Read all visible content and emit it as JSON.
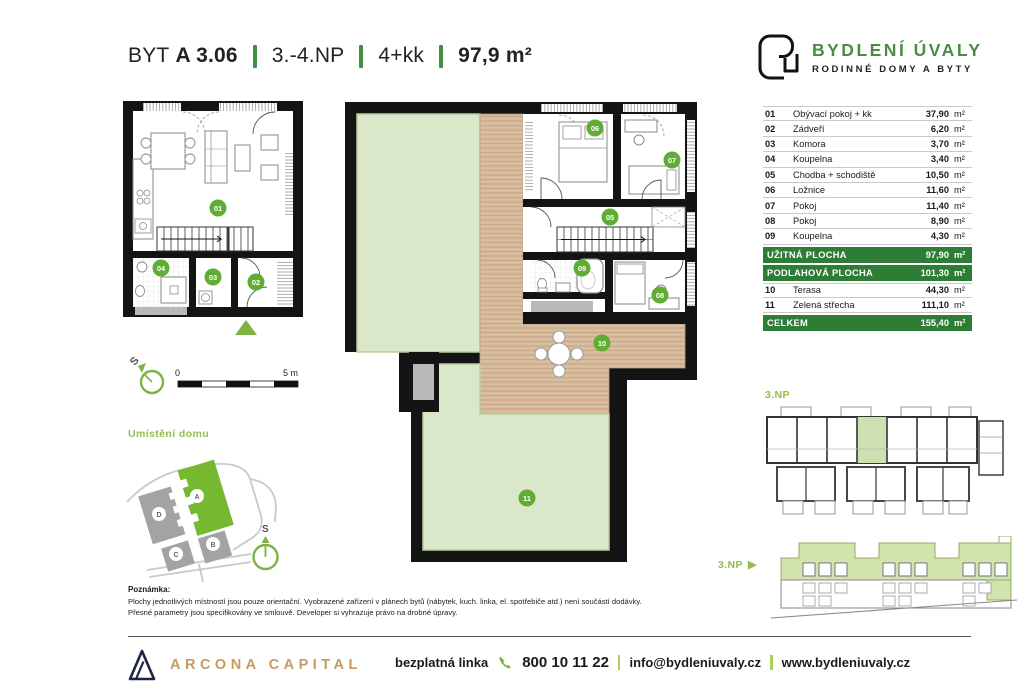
{
  "header": {
    "prefix": "BYT",
    "unit": "A 3.06",
    "floor": "3.-4.NP",
    "disposition": "4+kk",
    "area": "97,9 m²"
  },
  "brand": {
    "name": "BYDLENÍ ÚVALY",
    "tagline": "RODINNÉ DOMY A BYTY"
  },
  "area_table": {
    "rows": [
      {
        "num": "01",
        "name": "Obývací pokoj + kk",
        "value": "37,90",
        "unit": "m²"
      },
      {
        "num": "02",
        "name": "Zádveří",
        "value": "6,20",
        "unit": "m²"
      },
      {
        "num": "03",
        "name": "Komora",
        "value": "3,70",
        "unit": "m²"
      },
      {
        "num": "04",
        "name": "Koupelna",
        "value": "3,40",
        "unit": "m²"
      },
      {
        "num": "05",
        "name": "Chodba + schodiště",
        "value": "10,50",
        "unit": "m²"
      },
      {
        "num": "06",
        "name": "Ložnice",
        "value": "11,60",
        "unit": "m²"
      },
      {
        "num": "07",
        "name": "Pokoj",
        "value": "11,40",
        "unit": "m²"
      },
      {
        "num": "08",
        "name": "Pokoj",
        "value": "8,90",
        "unit": "m²"
      },
      {
        "num": "09",
        "name": "Koupelna",
        "value": "4,30",
        "unit": "m²"
      }
    ],
    "summary1": {
      "label": "UŽITNÁ PLOCHA",
      "value": "97,90",
      "unit": "m²"
    },
    "summary2": {
      "label": "PODLAHOVÁ PLOCHA",
      "value": "101,30",
      "unit": "m²"
    },
    "rows2": [
      {
        "num": "10",
        "name": "Terasa",
        "value": "44,30",
        "unit": "m²"
      },
      {
        "num": "11",
        "name": "Zelená střecha",
        "value": "111,10",
        "unit": "m²"
      }
    ],
    "total": {
      "label": "CELKEM",
      "value": "155,40",
      "unit": "m²"
    }
  },
  "site_plan": {
    "title": "Umístění domu",
    "buildings": [
      "A",
      "B",
      "C",
      "D"
    ],
    "north": "S"
  },
  "scale_bar": {
    "start": "0",
    "end": "5 m"
  },
  "compass": {
    "north": "S"
  },
  "floor_overview": {
    "label": "3.NP"
  },
  "elevation": {
    "label": "3.NP",
    "arrow": "▶"
  },
  "note": {
    "title": "Poznámka:",
    "line1": "Plochy jednotlivých místností jsou pouze orientační. Vyobrazené zařízení v plánech bytů (nábytek, kuch. linka, el. spotřebiče atd.) není součástí dodávky.",
    "line2": "Přesné parametry jsou specifikovány ve smlouvě. Developer si vyhrazuje právo na drobné úpravy."
  },
  "footer": {
    "company": "ARCONA CAPITAL",
    "phone_label": "bezplatná linka",
    "phone": "800 10 11 22",
    "email": "info@bydleniuvaly.cz",
    "web": "www.bydleniuvaly.cz"
  },
  "colors": {
    "dark_green": "#2e7d36",
    "badge_green": "#5fad33",
    "label_green": "#94bd4d",
    "wood": "#d8bd9f",
    "roof_green": "#dbe7c9",
    "gold": "#c69a60",
    "navy": "#1d2540"
  }
}
